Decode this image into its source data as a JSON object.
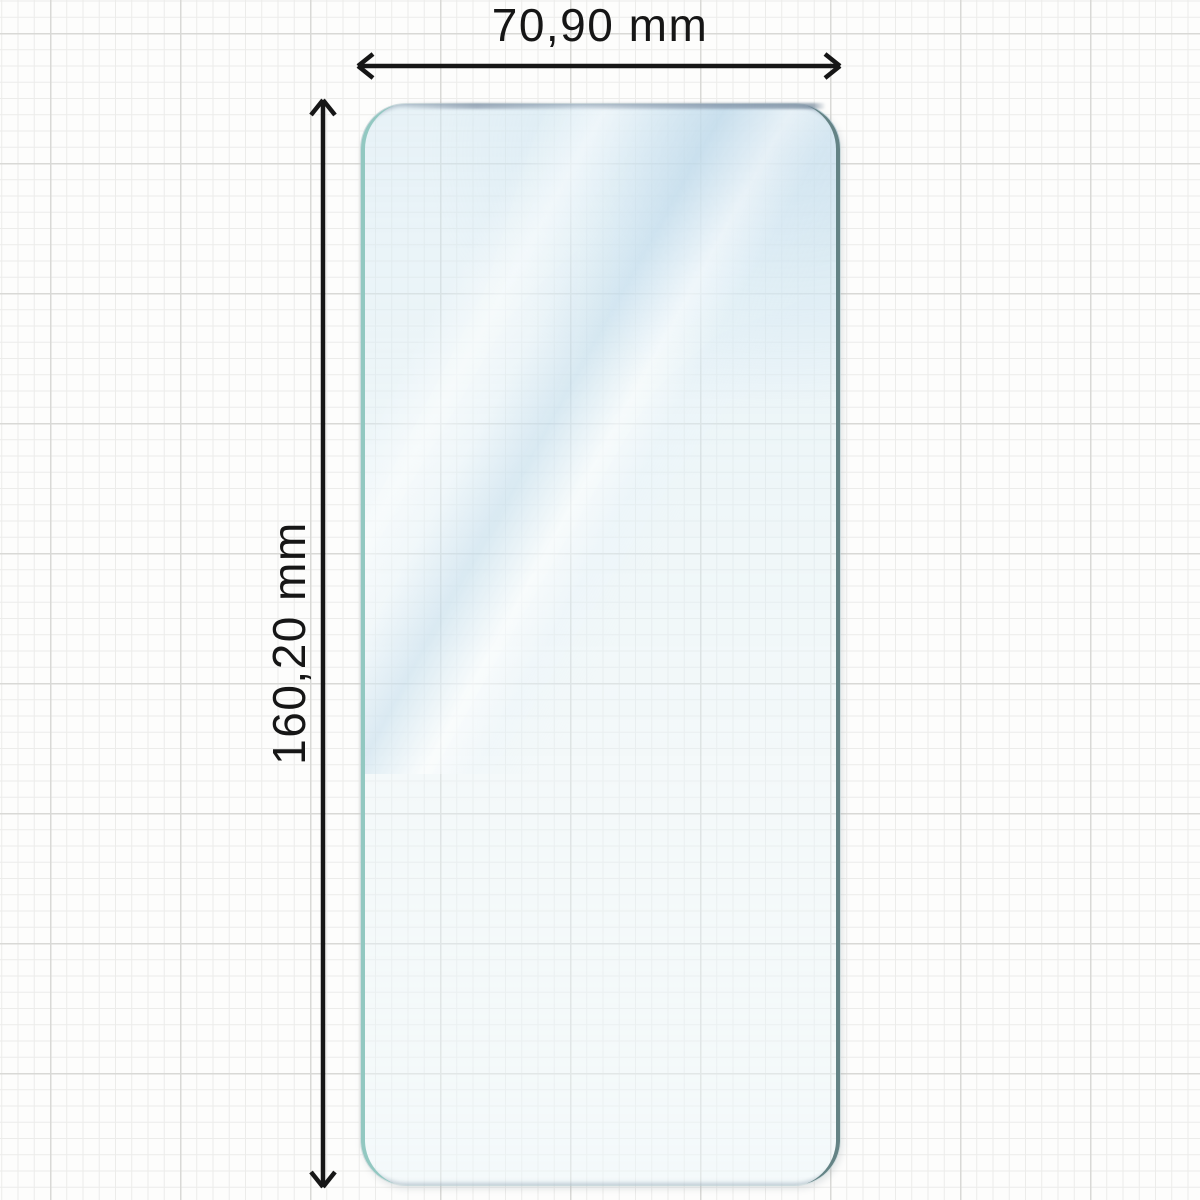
{
  "diagram": {
    "type": "product-dimension-diagram",
    "subject": "phone screen protector film on graph paper",
    "dimensions": {
      "width": {
        "label": "70,90 mm",
        "orientation": "horizontal"
      },
      "height": {
        "label": "160,20 mm",
        "orientation": "vertical"
      }
    }
  },
  "colors": {
    "paper": "#fdfdfc",
    "grid_minor": "#ececea",
    "grid_major": "#d9d9d6",
    "ink": "#161616",
    "glass_tint": "#d5e9f2",
    "glass_edge_left": "#92c8c1",
    "glass_edge_right": "#648385"
  }
}
